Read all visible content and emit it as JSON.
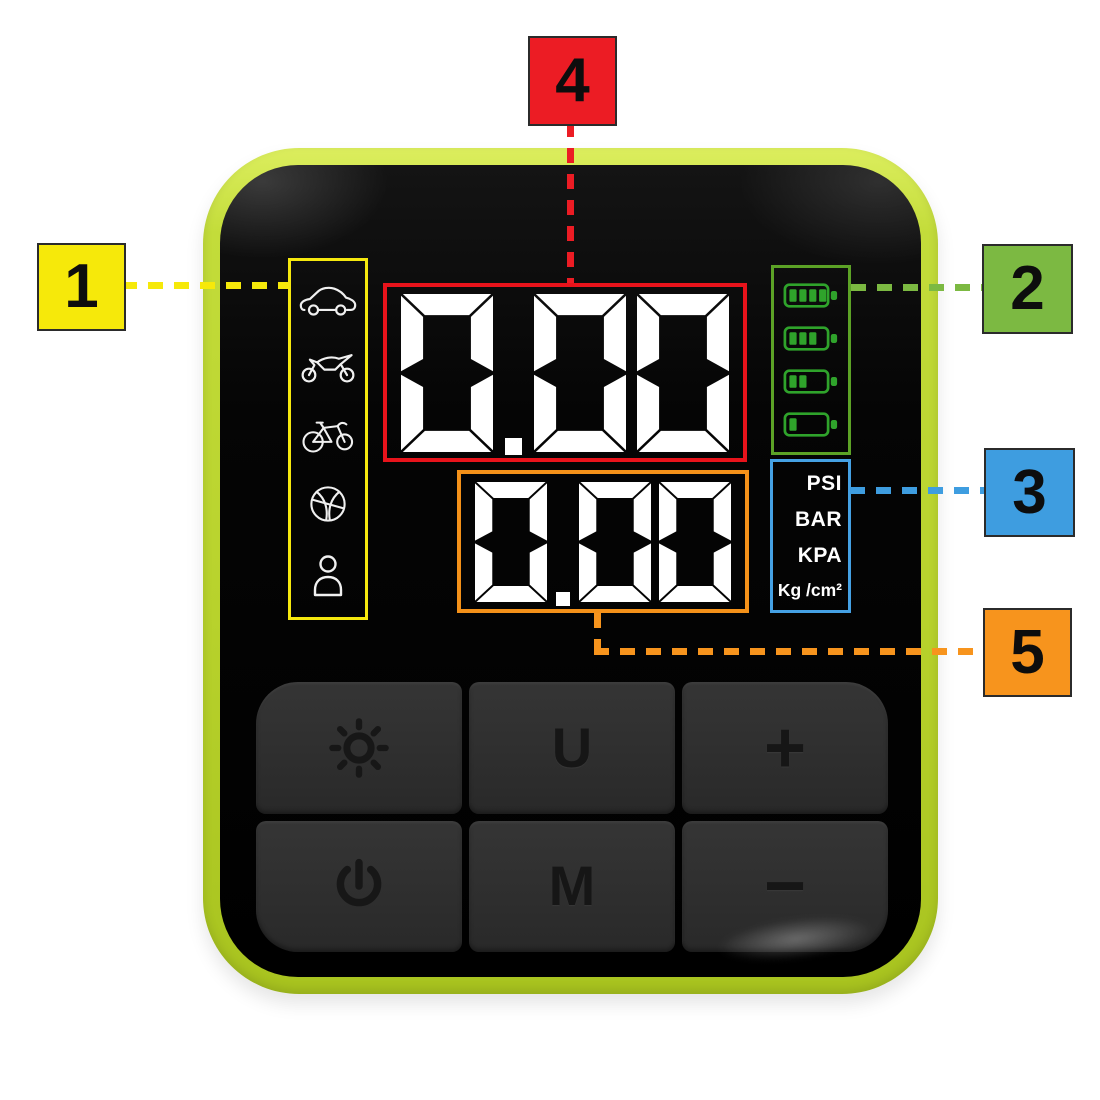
{
  "figure": {
    "description_visible_text_only": "",
    "background_color": "#ffffff"
  },
  "device": {
    "shell_color": "#b8d22c",
    "panel_color": "#050505"
  },
  "callouts": [
    {
      "label": "1",
      "color": "#f6e90a"
    },
    {
      "label": "2",
      "color": "#7cb942"
    },
    {
      "label": "3",
      "color": "#3e9de0"
    },
    {
      "label": "4",
      "color": "#ec1c24"
    },
    {
      "label": "5",
      "color": "#f7941d"
    }
  ],
  "screen": {
    "mode_panel": {
      "border_color": "#f5e80e",
      "icons": [
        "car",
        "motorcycle",
        "bicycle",
        "basketball",
        "person"
      ]
    },
    "main_display": {
      "value": "0.00",
      "border_color": "#e8131b",
      "digit_color": "#ffffff"
    },
    "sub_display": {
      "value": "0.00",
      "border_color": "#f49119",
      "digit_color": "#ffffff"
    },
    "battery_panel": {
      "border_color": "#5ca226",
      "icon_color": "#2fa32b",
      "levels": [
        4,
        3,
        2,
        1
      ],
      "max_bars": 4
    },
    "unit_panel": {
      "border_color": "#45a1e4",
      "text_color": "#ffffff",
      "options": [
        "PSI",
        "BAR",
        "KPA",
        "Kg /cm²"
      ]
    }
  },
  "keypad": {
    "buttons": [
      {
        "name": "brightness",
        "icon": "sun",
        "label": ""
      },
      {
        "name": "unit",
        "label": "U"
      },
      {
        "name": "increase",
        "label": "+"
      },
      {
        "name": "power",
        "icon": "power",
        "label": ""
      },
      {
        "name": "mode",
        "label": "M"
      },
      {
        "name": "decrease",
        "label": "−"
      }
    ]
  }
}
